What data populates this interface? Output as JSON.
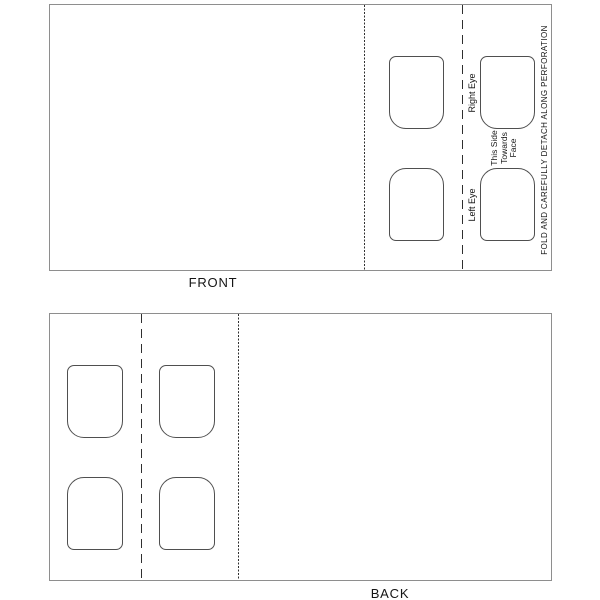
{
  "front_panel": {
    "caption": "FRONT",
    "right_eye_label": "Right Eye",
    "left_eye_label": "Left Eye",
    "side_note": {
      "line1": "This Side",
      "line2": "Towards",
      "line3": "Face"
    },
    "fold_note": "FOLD AND CAREFULLY DETACH ALONG PERFORATION"
  },
  "back_panel": {
    "caption": "BACK"
  },
  "colors": {
    "background": "#ffffff",
    "panel_border": "#8e8e8e",
    "hole_outline": "#4f4f4f",
    "fold_line": "#2f2f2f",
    "text": "#151515"
  }
}
